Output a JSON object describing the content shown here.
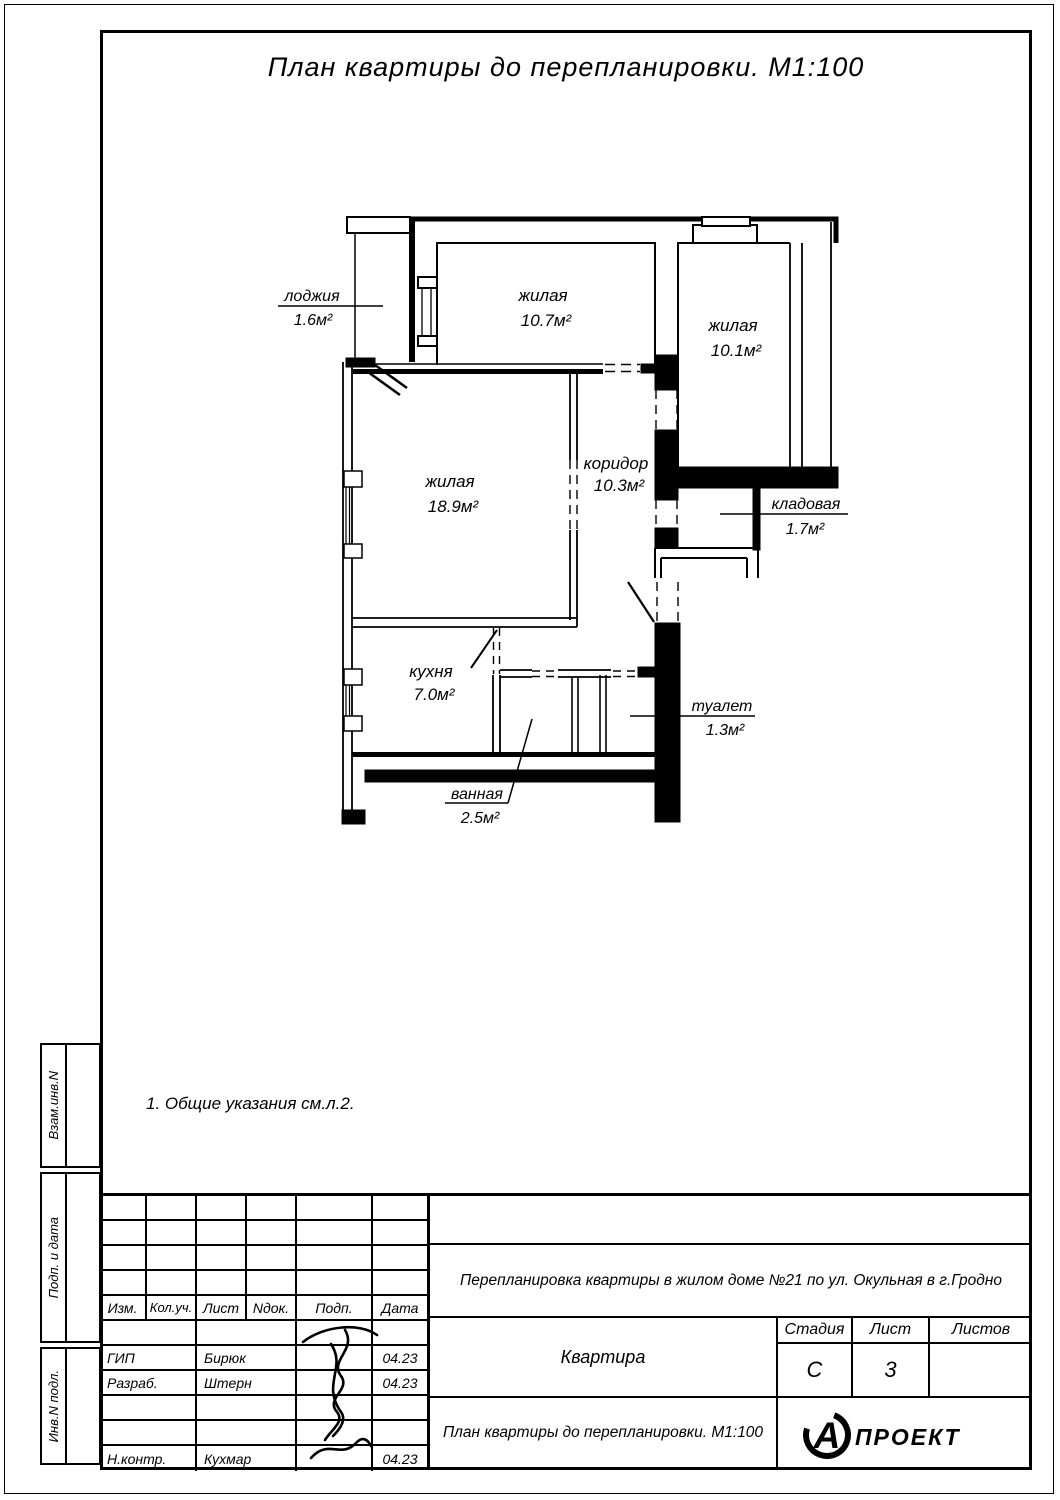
{
  "title": "План квартиры до перепланировки. М1:100",
  "note": "1. Общие указания см.л.2.",
  "plan": {
    "rooms": [
      {
        "name": "жилая",
        "area": "10.7м²"
      },
      {
        "name": "жилая",
        "area": "10.1м²"
      },
      {
        "name": "жилая",
        "area": "18.9м²"
      },
      {
        "name": "коридор",
        "area": "10.3м²"
      },
      {
        "name": "кухня",
        "area": "7.0м²"
      },
      {
        "name": "лоджия",
        "area": "1.6м²"
      },
      {
        "name": "кладовая",
        "area": "1.7м²"
      },
      {
        "name": "туалет",
        "area": "1.3м²"
      },
      {
        "name": "ванная",
        "area": "2.5м²"
      }
    ]
  },
  "titleblock": {
    "columns": [
      "Изм.",
      "Кол.уч.",
      "Лист",
      "Nдок.",
      "Подп.",
      "Дата"
    ],
    "staff": [
      {
        "role": "ГИП",
        "name": "Бирюк",
        "date": "04.23"
      },
      {
        "role": "Разраб.",
        "name": "Штерн",
        "date": "04.23"
      },
      {
        "role": "Н.контр.",
        "name": "Кухмар",
        "date": "04.23"
      }
    ],
    "project": "Перепланировка квартиры в жилом доме №21 по ул. Окульная в г.Гродно",
    "object": "Квартира",
    "drawing": "План квартиры до перепланировки. М1:100",
    "stage_label": "Стадия",
    "stage": "С",
    "sheet_label": "Лист",
    "sheet": "3",
    "sheets_label": "Листов",
    "sheets": "",
    "logo_letter": "А",
    "logo_text": "ПРОЕКТ"
  },
  "sidebar": {
    "labels": [
      "Взам.инв.N",
      "Подп. и дата",
      "Инв.N подл."
    ]
  }
}
